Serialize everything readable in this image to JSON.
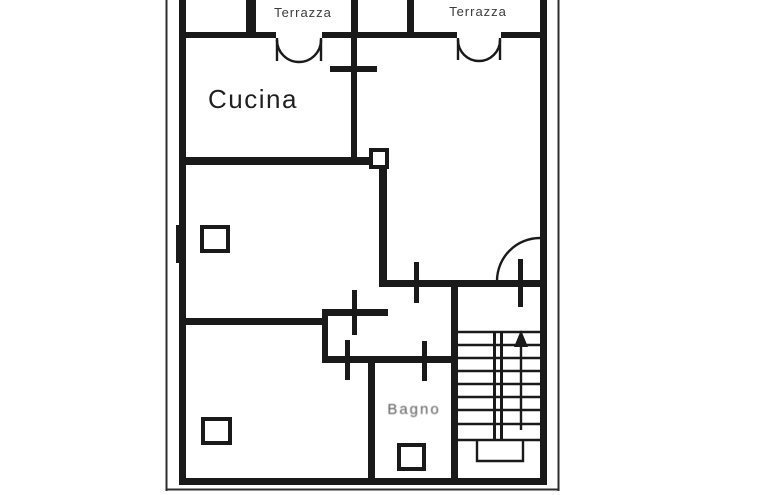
{
  "page": {
    "background": "#ffffff",
    "ink_color": "#1a1a1a"
  },
  "drawing": {
    "kind": "floor-plan-scan",
    "labels": {
      "terrazza_left": "Terrazza",
      "terrazza_right": "Terrazza",
      "cucina": "Cucina",
      "bagno": "Bagno"
    },
    "stairs": {
      "direction": "up",
      "step_lines": 9
    }
  }
}
